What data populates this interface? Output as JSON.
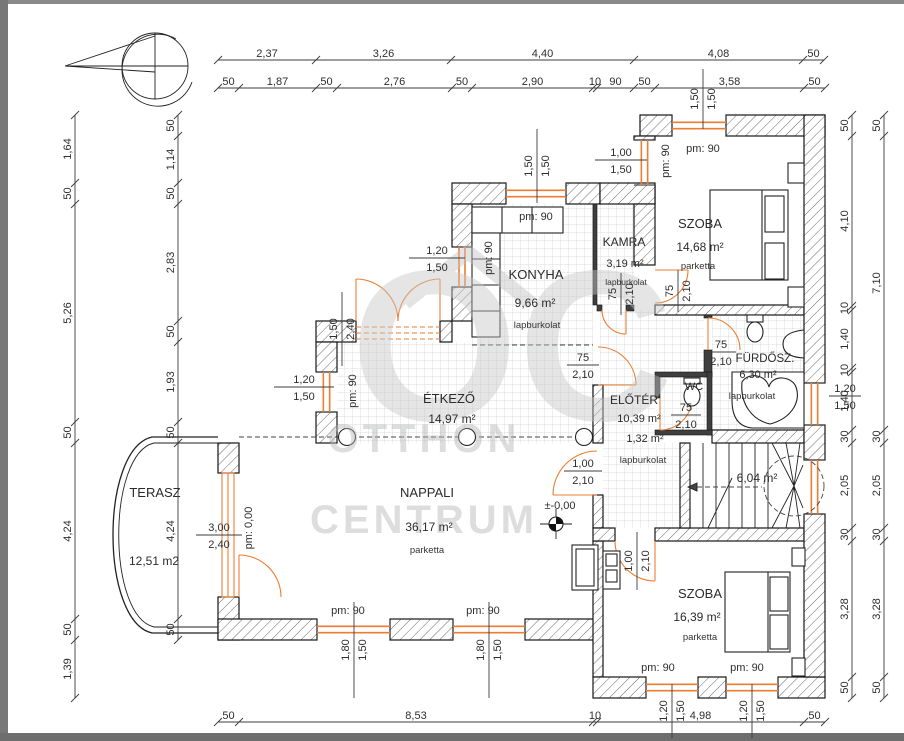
{
  "watermark": {
    "monogram": "OC",
    "line1": "OTTHON",
    "line2": "CENTRUM"
  },
  "level_marker": {
    "text": "±-0,00"
  },
  "rooms": [
    {
      "id": "terasz",
      "name": "TERASZ",
      "area": "12,51 m2",
      "floor": ""
    },
    {
      "id": "nappali",
      "name": "NAPPALI",
      "area": "36,17 m²",
      "floor": "parketta"
    },
    {
      "id": "etkezo",
      "name": "ÉTKEZŐ",
      "area": "14,97 m²",
      "floor": ""
    },
    {
      "id": "konyha",
      "name": "KONYHA",
      "area": "9,66 m²",
      "floor": "lapburkolat"
    },
    {
      "id": "kamra",
      "name": "KAMRA",
      "area": "3,19 m²",
      "floor": "lapburkolat"
    },
    {
      "id": "szoba-felso",
      "name": "SZOBA",
      "area": "14,68 m²",
      "floor": "parketta"
    },
    {
      "id": "furdoszoba",
      "name": "FÜRDŐSZ.",
      "area": "6,30 m²",
      "floor": "lapburkolat"
    },
    {
      "id": "wc",
      "name": "WC",
      "area": "1,32 m²",
      "floor": ""
    },
    {
      "id": "eloter",
      "name": "ELŐTÉR",
      "area": "10,39 m²",
      "floor": "lapburkolat"
    },
    {
      "id": "lepcso",
      "name": "",
      "area": "6,04 m²",
      "floor": ""
    },
    {
      "id": "szoba-also",
      "name": "SZOBA",
      "area": "16,39 m²",
      "floor": "parketta"
    }
  ],
  "dim_chains": [
    {
      "id": "top-row-1",
      "labels": [
        "2,37",
        "3,26",
        "4,40",
        "4,08",
        "50"
      ]
    },
    {
      "id": "top-row-2",
      "labels": [
        "50",
        "1,87",
        "50",
        "2,76",
        "50",
        "2,90",
        "10",
        "90",
        "50",
        "3,58",
        "50"
      ]
    },
    {
      "id": "bottom-row",
      "labels": [
        "50",
        "8,53",
        "10",
        "4,98",
        "50"
      ]
    },
    {
      "id": "left-outer",
      "labels": [
        "1,64",
        "50",
        "5,26",
        "50",
        "4,24",
        "50",
        "1,39"
      ]
    },
    {
      "id": "left-inner",
      "labels": [
        "50",
        "1,14",
        "50",
        "2,83",
        "50",
        "1,93",
        "50",
        "4,24",
        "50"
      ]
    },
    {
      "id": "right-inner",
      "labels": [
        "50",
        "4,10",
        "10",
        "1,40",
        "10",
        "1,40",
        "30",
        "2,05",
        "30",
        "3,28",
        "50"
      ]
    },
    {
      "id": "right-outer",
      "labels": [
        "50",
        "7,10",
        "30",
        "2,05",
        "30",
        "3,28",
        "50"
      ]
    }
  ],
  "dim_pairs": [
    {
      "id": "win-etkezo-left",
      "a": "1,20",
      "b": "1,50"
    },
    {
      "id": "win-konyha-left",
      "a": "1,20",
      "b": "1,50"
    },
    {
      "id": "win-vestibule",
      "a": "1,00",
      "b": "1,50"
    },
    {
      "id": "door-nappali",
      "a": "1,00",
      "b": "2,10"
    },
    {
      "id": "door-etkezo",
      "a": "75",
      "b": "2,10"
    },
    {
      "id": "door-furdo",
      "a": "75",
      "b": "2,10"
    },
    {
      "id": "door-wc",
      "a": "75",
      "b": "2,10"
    },
    {
      "id": "door-terasz",
      "a": "3,00",
      "b": "2,40"
    },
    {
      "id": "win-right",
      "a": "1,20",
      "b": "1,50"
    },
    {
      "id": "open-etkezo-top",
      "a": "1,50",
      "b": "2,40"
    },
    {
      "id": "win-konyha-top",
      "a": "1,50",
      "b": "1,50"
    },
    {
      "id": "win-szoba-top",
      "a": "1,50",
      "b": "1,50"
    },
    {
      "id": "win-nappali-1",
      "a": "1,80",
      "b": "1,50"
    },
    {
      "id": "win-nappali-2",
      "a": "1,80",
      "b": "1,50"
    },
    {
      "id": "win-szoba2-1",
      "a": "1,20",
      "b": "1,50"
    },
    {
      "id": "win-szoba2-2",
      "a": "1,20",
      "b": "1,50"
    },
    {
      "id": "door-szoba2",
      "a": "1,00",
      "b": "2,10"
    },
    {
      "id": "door-kamra",
      "a": "75",
      "b": "2,10"
    },
    {
      "id": "door-szoba1",
      "a": "75",
      "b": "2,10"
    }
  ],
  "pm_labels": [
    {
      "id": "pm-konyha-top",
      "text": "pm: 90"
    },
    {
      "id": "pm-konyha-left",
      "text": "pm: 90"
    },
    {
      "id": "pm-szoba1-top",
      "text": "pm: 90"
    },
    {
      "id": "pm-vestibule",
      "text": "pm: 90"
    },
    {
      "id": "pm-etkezo-left",
      "text": "pm: 90"
    },
    {
      "id": "pm-terasz",
      "text": "pm: 0,00"
    },
    {
      "id": "pm-nappali-1",
      "text": "pm: 90"
    },
    {
      "id": "pm-nappali-2",
      "text": "pm: 90"
    },
    {
      "id": "pm-szoba2-1",
      "text": "pm: 90"
    },
    {
      "id": "pm-szoba2-2",
      "text": "pm: 90"
    }
  ],
  "colors": {
    "accent": "#ed7d31",
    "wall_line": "#161616",
    "dim_text": "#2e2e2e",
    "tile_line": "#ccd3d8",
    "watermark": "#c3c3c3",
    "frame": "#787878"
  }
}
